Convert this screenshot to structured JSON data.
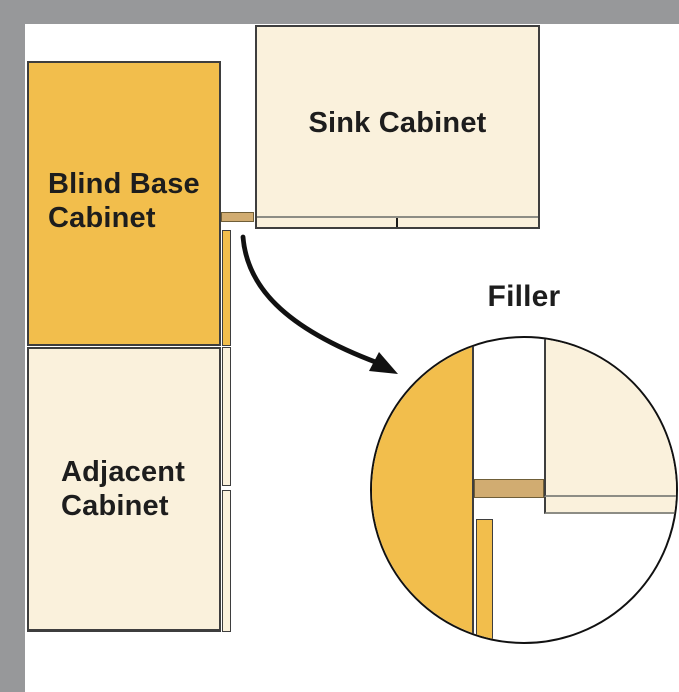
{
  "diagram": {
    "type": "kitchen-corner-cabinet-plan",
    "cabinets": {
      "blind_base": {
        "label_line1": "Blind Base",
        "label_line2": "Cabinet"
      },
      "sink": {
        "label": "Sink Cabinet"
      },
      "adjacent": {
        "label_line1": "Adjacent",
        "label_line2": "Cabinet"
      }
    },
    "detail": {
      "label": "Filler"
    },
    "colors": {
      "wall_gray": "#97989A",
      "cabinet_orange": "#F2BE4C",
      "cabinet_cream": "#FAF1DC",
      "filler_tan": "#D1AC71",
      "outline_dark": "#3E3E3E",
      "filler_outline": "#6F5E38",
      "line_gray": "#8D8D85",
      "text_dark": "#1D1D1D",
      "circle_outline": "#111111"
    }
  }
}
